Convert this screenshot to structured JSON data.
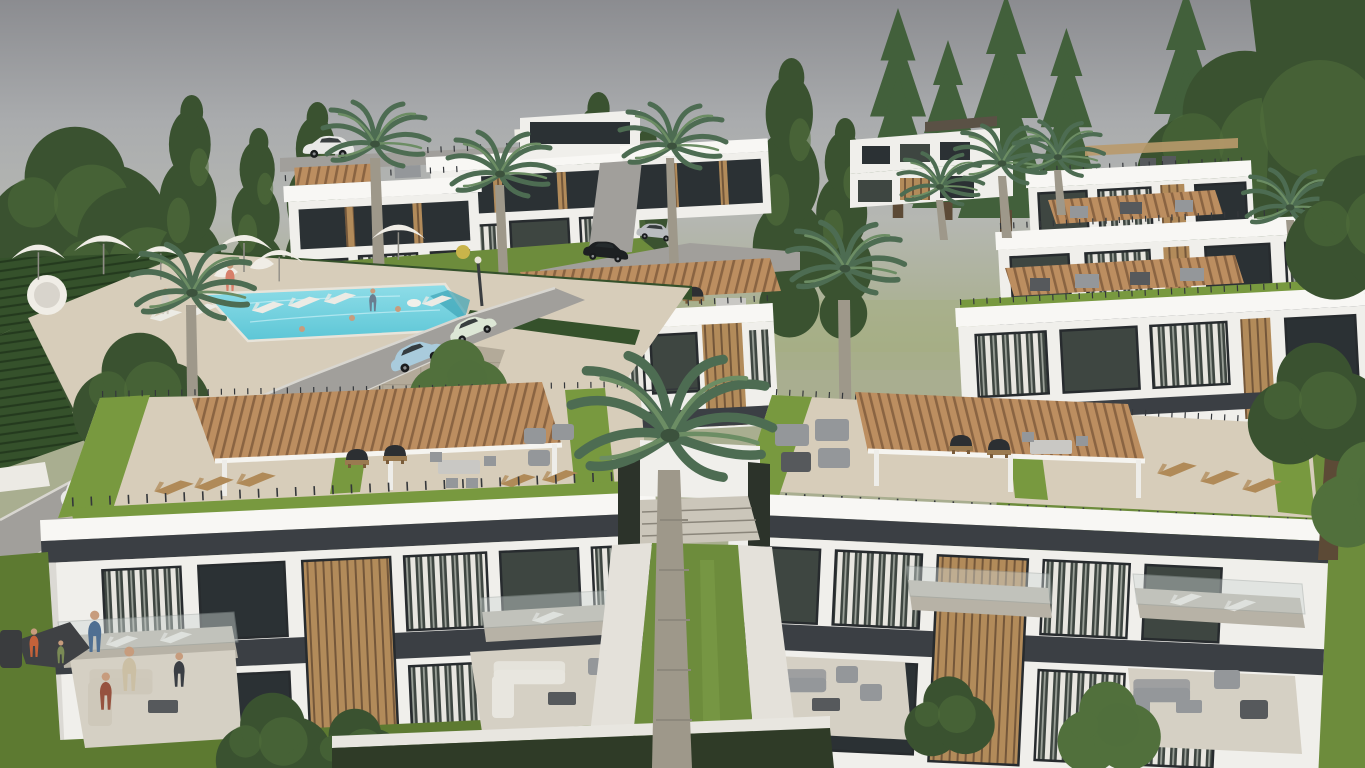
{
  "title": "Aerial 3D architectural rendering of a hillside residential complex: white modern villas with rooftop terraces and wooden pergolas, a swimming pool with umbrellas and loungers, winding roads with cars, palm trees and lawns under an overcast sky",
  "scene": {
    "setting": "hillside residential development, overcast grey sky with green haze at the horizon",
    "elements": [
      "overcast sky",
      "background tree line",
      "hillside villas",
      "terraced hedge gardens",
      "swimming pool with swimmers and float",
      "pool umbrellas and sun loungers",
      "round daybed pod",
      "curving access roads",
      "parked and driving cars",
      "street lamps",
      "litter bin",
      "modern white apartment buildings",
      "rooftop terraces with wooden pergolas",
      "rooftop barbecue grills and outdoor furniture",
      "green sedum roof border strips",
      "balconies with glass railings",
      "wood-slat facade accents",
      "curtained window walls",
      "central tall palm tree",
      "scattered palm trees",
      "stone retaining walls",
      "ground floor patios with sofa sets",
      "residents and children on lawns",
      "shrubs and hedges"
    ]
  },
  "colors": {
    "sky-top": "#8b8c90",
    "sky-mid": "#aaacae",
    "sky-low": "#b5b7b2",
    "horizon": "#a6ae85",
    "tree-dark": "#3a5230",
    "tree-mid": "#51703c",
    "conifer": "#42603b",
    "palm-green": "#4d6c52",
    "palm-light": "#6c8d64",
    "palm-trunk": "#9e988a",
    "building-white": "#f0efeb",
    "fascia-white": "#f8f7f4",
    "building-shade": "#dbd9d4",
    "band-dark": "#3b3f44",
    "rail-dark": "#34373b",
    "glass-dark": "#3e4641",
    "glass-deep": "#2b3134",
    "curtain-light": "#e8e6e0",
    "wood-slat": "#b28b5a",
    "wood-dark": "#74573a",
    "pergola": "#bc8e60",
    "pergola-line": "#8a6442",
    "roof-grass": "#78993f",
    "grass": "#6d8c3c",
    "grass-dark": "#5d7a31",
    "grass-bright": "#7fa04a",
    "deck": "#d7cdba",
    "stone-wall": "#b3aa99",
    "stone-dark": "#988f7e",
    "road": "#a19f9b",
    "curb": "#d8d6d0",
    "path-light": "#e4e1da",
    "pool-light": "#8fdde8",
    "pool-main": "#5cc6d6",
    "pool-deep": "#3da4b6",
    "hedge-dark": "#35512b",
    "hedge-line": "#243a1e",
    "umbrella-white": "#f0ede6",
    "furniture-grey": "#94979a",
    "furniture-dark": "#56595c",
    "furniture-light": "#c9c8c4",
    "sofa-beige": "#cec8ba",
    "lounger-wood": "#b08a58",
    "balcony-tile": "#b7b2a6",
    "skin": "#c79c7d",
    "car-white": "#e9e9e7",
    "car-black": "#1d2022",
    "car-silver": "#b9bcbf",
    "car-blue": "#a9cbdc",
    "car-pale": "#dde7d6"
  }
}
